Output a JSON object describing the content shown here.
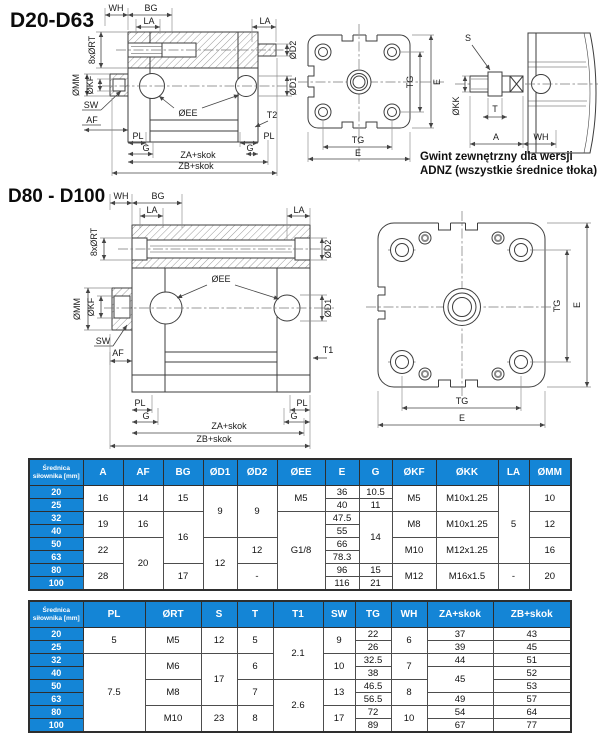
{
  "titles": {
    "d20": "D20-D63",
    "d80": "D80 - D100"
  },
  "caption": {
    "line1": "Gwint zewnętrzny dla wersji",
    "line2": "ADNZ (wszystkie średnice tłoka)"
  },
  "colors": {
    "accent": "#1485d6",
    "line": "#3d3d3d"
  },
  "dim_labels": {
    "wh": "WH",
    "bg": "BG",
    "la": "LA",
    "rt": "8xØRT",
    "d2": "ØD2",
    "d1": "ØD1",
    "mm": "ØMM",
    "kf": "ØKF",
    "sw": "SW",
    "af": "AF",
    "ee": "ØEE",
    "t2": "T2",
    "t1": "T1",
    "pl": "PL",
    "g": "G",
    "za": "ZA+skok",
    "zb": "ZB+skok",
    "tg": "TG",
    "e": "E",
    "s": "S",
    "kk": "ØKK",
    "t": "T",
    "a": "A"
  },
  "table1": {
    "row_header_title": "Średnica siłownika [mm]",
    "col_headers": [
      "A",
      "AF",
      "BG",
      "ØD1",
      "ØD2",
      "ØEE",
      "E",
      "G",
      "ØKF",
      "ØKK",
      "LA",
      "ØMM"
    ],
    "row_headers": [
      "20",
      "25",
      "32",
      "40",
      "50",
      "63",
      "80",
      "100"
    ],
    "columns": [
      {
        "cells": [
          {
            "v": "16",
            "span": 2
          },
          {
            "v": "19",
            "span": 2
          },
          {
            "v": "22",
            "span": 2
          },
          {
            "v": "28",
            "span": 2
          }
        ]
      },
      {
        "cells": [
          {
            "v": "14",
            "span": 2
          },
          {
            "v": "16",
            "span": 2
          },
          {
            "v": "20",
            "span": 4
          }
        ]
      },
      {
        "cells": [
          {
            "v": "15",
            "span": 2
          },
          {
            "v": "16",
            "span": 4
          },
          {
            "v": "17",
            "span": 2
          }
        ]
      },
      {
        "cells": [
          {
            "v": "9",
            "span": 4
          },
          {
            "v": "12",
            "span": 4
          }
        ]
      },
      {
        "cells": [
          {
            "v": "9",
            "span": 4
          },
          {
            "v": "12",
            "span": 2
          },
          {
            "v": "-",
            "span": 2
          }
        ]
      },
      {
        "cells": [
          {
            "v": "M5",
            "span": 2
          },
          {
            "v": "G1/8",
            "span": 6
          }
        ]
      },
      {
        "cells": [
          {
            "v": "36"
          },
          {
            "v": "40"
          },
          {
            "v": "47.5"
          },
          {
            "v": "55"
          },
          {
            "v": "66"
          },
          {
            "v": "78.3"
          },
          {
            "v": "96"
          },
          {
            "v": "116"
          }
        ]
      },
      {
        "cells": [
          {
            "v": "10.5"
          },
          {
            "v": "11"
          },
          {
            "v": "14",
            "span": 4
          },
          {
            "v": "15"
          },
          {
            "v": "21"
          }
        ]
      },
      {
        "cells": [
          {
            "v": "M5",
            "span": 2
          },
          {
            "v": "M8",
            "span": 2
          },
          {
            "v": "M10",
            "span": 2
          },
          {
            "v": "M12",
            "span": 2
          }
        ]
      },
      {
        "cells": [
          {
            "v": "M10x1.25",
            "span": 2
          },
          {
            "v": "M10x1.25",
            "span": 2
          },
          {
            "v": "M12x1.25",
            "span": 2
          },
          {
            "v": "M16x1.5",
            "span": 2
          }
        ]
      },
      {
        "cells": [
          {
            "v": "5",
            "span": 6
          },
          {
            "v": "-",
            "span": 2
          }
        ]
      },
      {
        "cells": [
          {
            "v": "10",
            "span": 2
          },
          {
            "v": "12",
            "span": 2
          },
          {
            "v": "16",
            "span": 2
          },
          {
            "v": "20",
            "span": 2
          }
        ]
      }
    ]
  },
  "table2": {
    "row_header_title": "Średnica siłownika [mm]",
    "col_headers": [
      "PL",
      "ØRT",
      "S",
      "T",
      "T1",
      "SW",
      "TG",
      "WH",
      "ZA+skok",
      "ZB+skok"
    ],
    "row_headers": [
      "20",
      "25",
      "32",
      "40",
      "50",
      "63",
      "80",
      "100"
    ],
    "columns": [
      {
        "cells": [
          {
            "v": "5",
            "span": 2
          },
          {
            "v": "7.5",
            "span": 6
          }
        ]
      },
      {
        "cells": [
          {
            "v": "M5",
            "span": 2
          },
          {
            "v": "M6",
            "span": 2
          },
          {
            "v": "M8",
            "span": 2
          },
          {
            "v": "M10",
            "span": 2
          }
        ]
      },
      {
        "cells": [
          {
            "v": "12",
            "span": 2
          },
          {
            "v": "17",
            "span": 4
          },
          {
            "v": "23",
            "span": 2
          }
        ]
      },
      {
        "cells": [
          {
            "v": "5",
            "span": 2
          },
          {
            "v": "6",
            "span": 2
          },
          {
            "v": "7",
            "span": 2
          },
          {
            "v": "8",
            "span": 2
          }
        ]
      },
      {
        "cells": [
          {
            "v": "2.1",
            "span": 4
          },
          {
            "v": "2.6",
            "span": 4
          }
        ]
      },
      {
        "cells": [
          {
            "v": "9",
            "span": 2
          },
          {
            "v": "10",
            "span": 2
          },
          {
            "v": "13",
            "span": 2
          },
          {
            "v": "17",
            "span": 2
          }
        ]
      },
      {
        "cells": [
          {
            "v": "22"
          },
          {
            "v": "26"
          },
          {
            "v": "32.5"
          },
          {
            "v": "38"
          },
          {
            "v": "46.5"
          },
          {
            "v": "56.5"
          },
          {
            "v": "72"
          },
          {
            "v": "89"
          }
        ]
      },
      {
        "cells": [
          {
            "v": "6",
            "span": 2
          },
          {
            "v": "7",
            "span": 2
          },
          {
            "v": "8",
            "span": 2
          },
          {
            "v": "10",
            "span": 2
          }
        ]
      },
      {
        "cells": [
          {
            "v": "37"
          },
          {
            "v": "39"
          },
          {
            "v": "44"
          },
          {
            "v": "45",
            "span": 2
          },
          {
            "v": "49"
          },
          {
            "v": "54"
          },
          {
            "v": "67"
          }
        ]
      },
      {
        "cells": [
          {
            "v": "43"
          },
          {
            "v": "45"
          },
          {
            "v": "51"
          },
          {
            "v": "52"
          },
          {
            "v": "53"
          },
          {
            "v": "57"
          },
          {
            "v": "64"
          },
          {
            "v": "77"
          }
        ]
      }
    ]
  }
}
